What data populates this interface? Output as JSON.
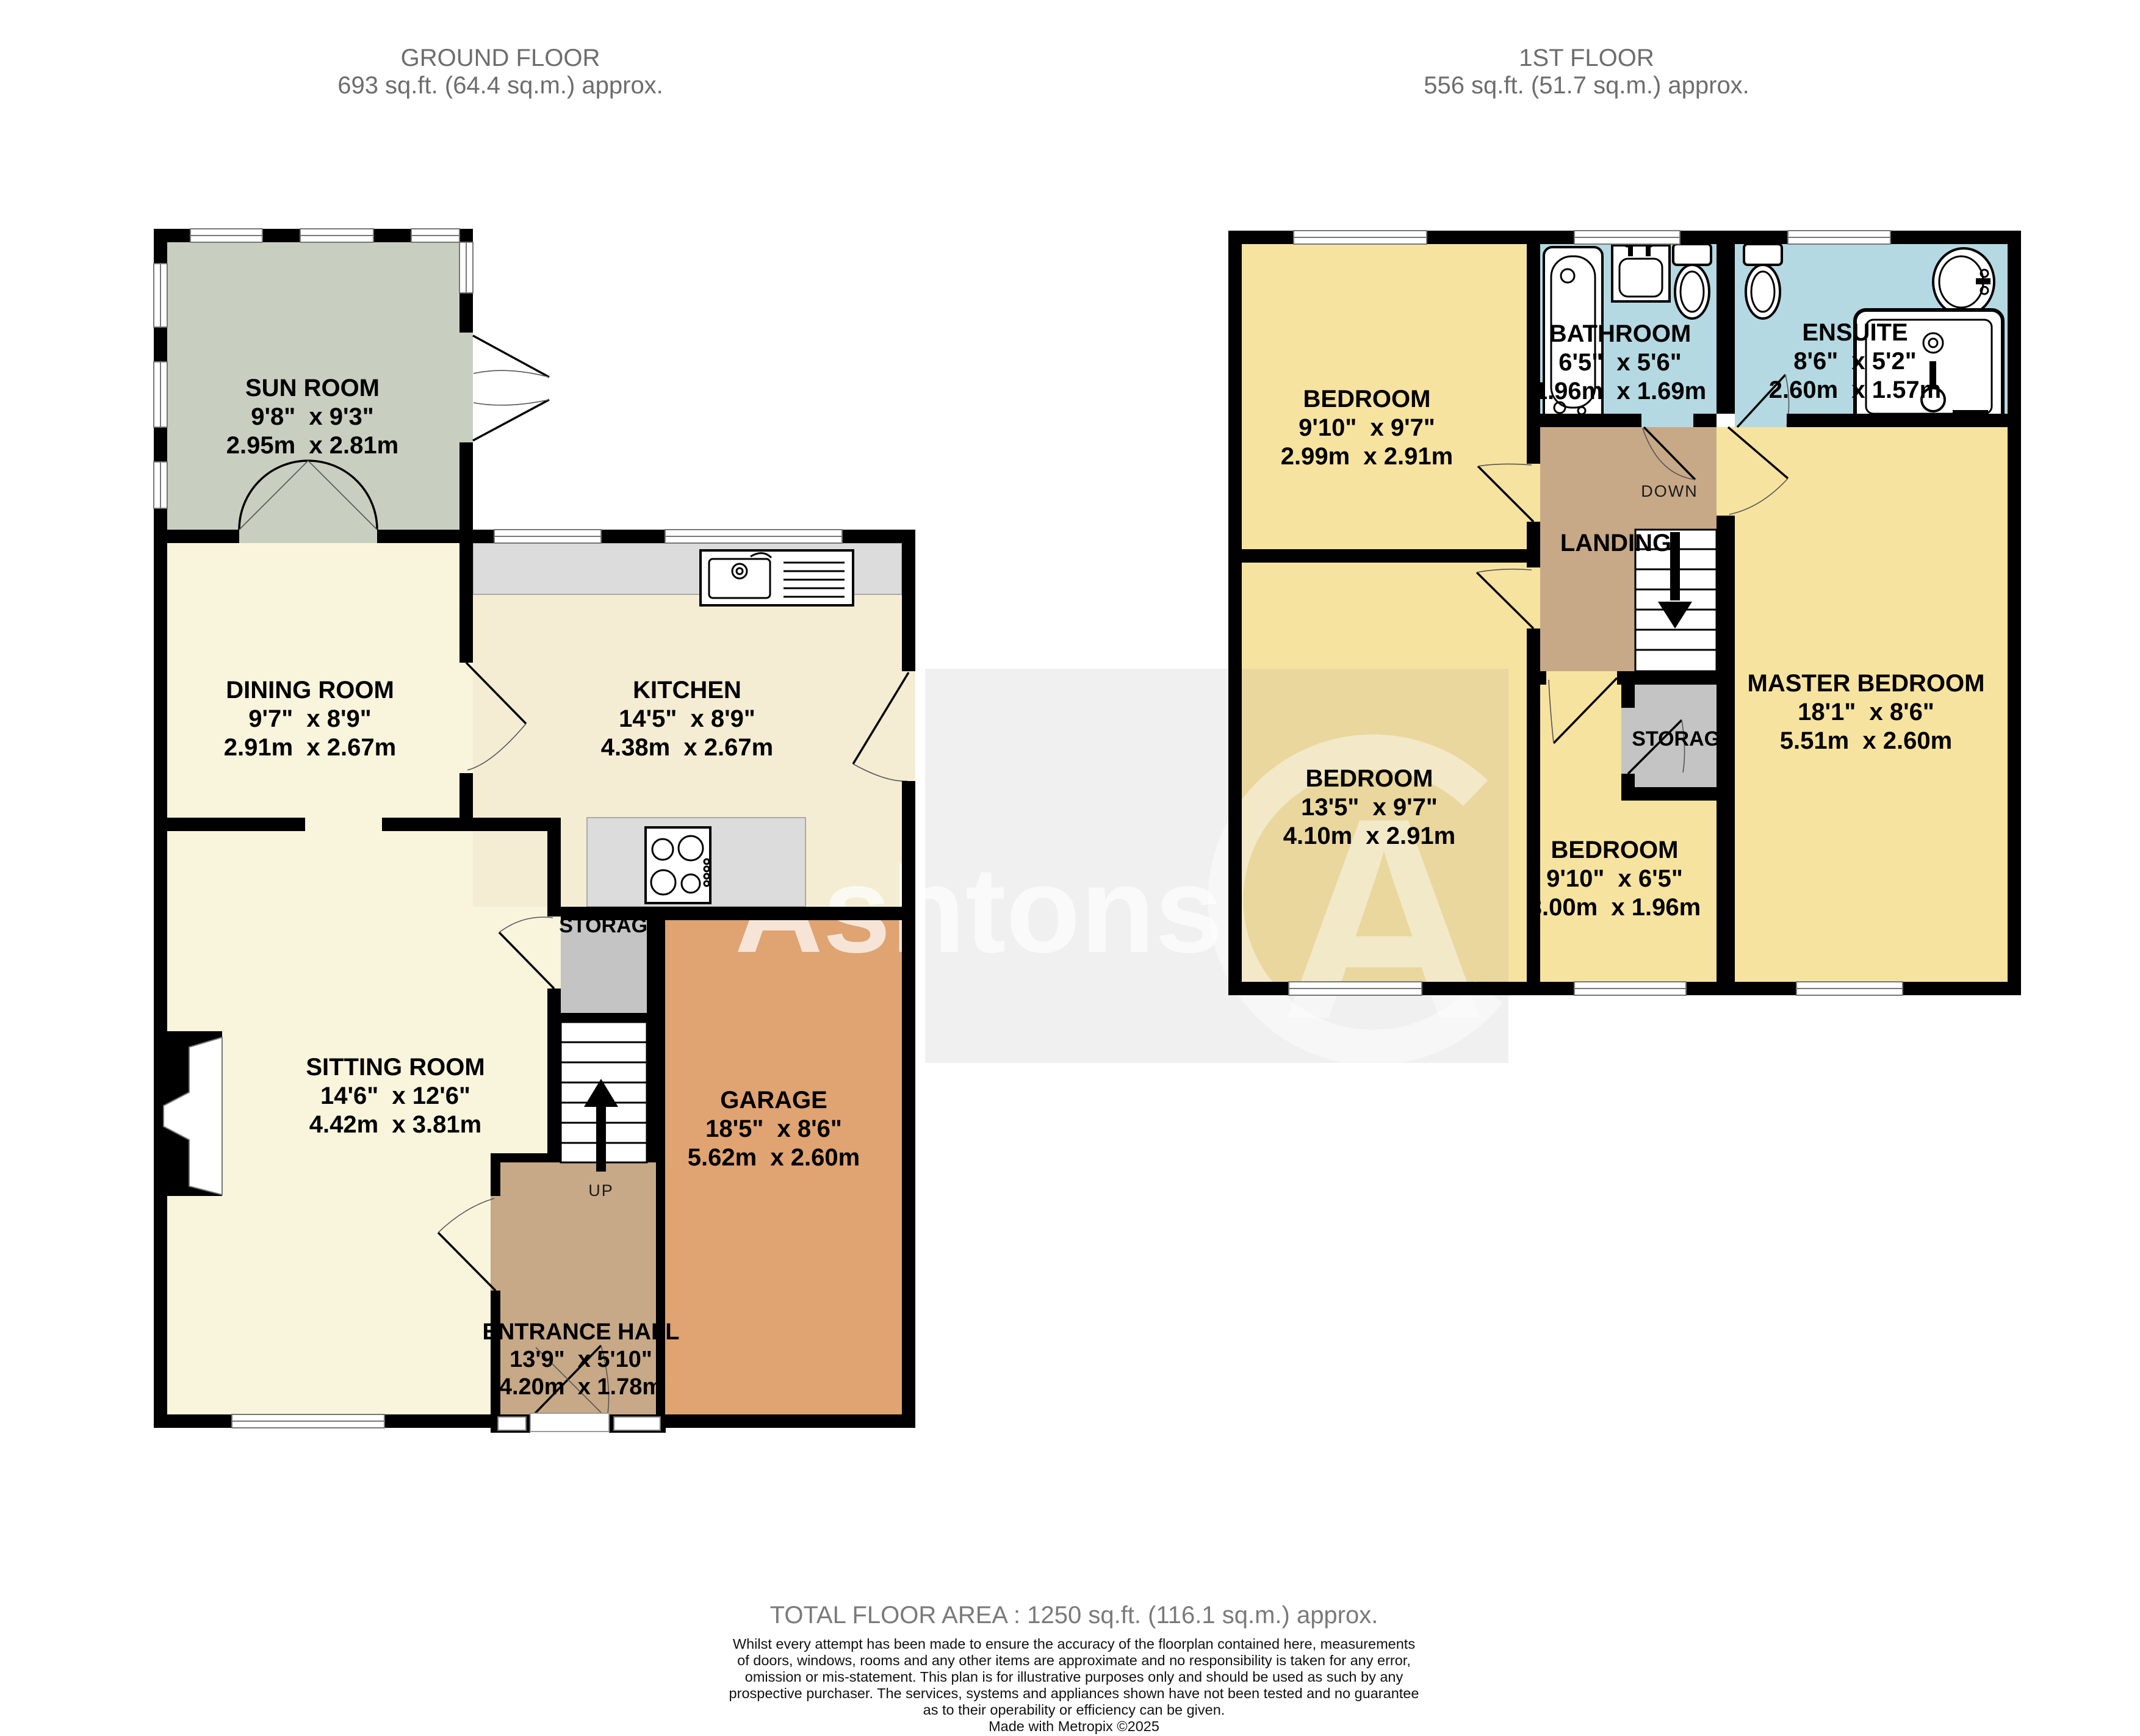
{
  "floors": {
    "ground": {
      "title": "GROUND FLOOR",
      "area": "693 sq.ft. (64.4 sq.m.) approx."
    },
    "first": {
      "title": "1ST FLOOR",
      "area": "556 sq.ft. (51.7 sq.m.) approx."
    }
  },
  "rooms": {
    "sun_room": {
      "name": "SUN ROOM",
      "imperial": "9'8\"  x 9'3\"",
      "metric": "2.95m  x 2.81m"
    },
    "dining_room": {
      "name": "DINING ROOM",
      "imperial": "9'7\"  x 8'9\"",
      "metric": "2.91m  x 2.67m"
    },
    "kitchen": {
      "name": "KITCHEN",
      "imperial": "14'5\"  x 8'9\"",
      "metric": "4.38m  x 2.67m"
    },
    "sitting_room": {
      "name": "SITTING ROOM",
      "imperial": "14'6\"  x 12'6\"",
      "metric": "4.42m  x 3.81m"
    },
    "garage": {
      "name": "GARAGE",
      "imperial": "18'5\"  x 8'6\"",
      "metric": "5.62m  x 2.60m"
    },
    "entrance_hall": {
      "name": "ENTRANCE HALL",
      "imperial": "13'9\"  x 5'10\"",
      "metric": "4.20m  x 1.78m"
    },
    "bedroom_front": {
      "name": "BEDROOM",
      "imperial": "9'10\"  x 9'7\"",
      "metric": "2.99m  x 2.91m"
    },
    "bathroom": {
      "name": "BATHROOM",
      "imperial": "6'5\"  x 5'6\"",
      "metric": "1.96m  x 1.69m"
    },
    "ensuite": {
      "name": "ENSUITE",
      "imperial": "8'6\"  x 5'2\"",
      "metric": "2.60m  x 1.57m"
    },
    "bedroom_middle": {
      "name": "BEDROOM",
      "imperial": "13'5\"  x 9'7\"",
      "metric": "4.10m  x 2.91m"
    },
    "bedroom_small": {
      "name": "BEDROOM",
      "imperial": "9'10\"  x 6'5\"",
      "metric": "3.00m  x 1.96m"
    },
    "master_bedroom": {
      "name": "MASTER BEDROOM",
      "imperial": "18'1\"  x 8'6\"",
      "metric": "5.51m  x 2.60m"
    }
  },
  "labels": {
    "storage_ground": "STORAGE",
    "storage_first": "STORAGE",
    "landing": "LANDING",
    "up": "UP",
    "down": "DOWN"
  },
  "watermark": {
    "text": "Ashtons",
    "logo_letter": "A"
  },
  "footer": {
    "total": "TOTAL FLOOR AREA : 1250 sq.ft. (116.1 sq.m.) approx.",
    "disclaimer_lines": [
      "Whilst every attempt has been made to ensure the accuracy of the floorplan contained here, measurements",
      "of doors, windows, rooms and any other items are approximate and no responsibility is taken for any error,",
      "omission or mis-statement. This plan is for illustrative purposes only and should be used as such by any",
      "prospective purchaser. The services, systems and appliances shown have not been tested and no guarantee",
      "as to their operability or efficiency can be given."
    ],
    "credit": "Made with Metropix ©2025"
  },
  "colors": {
    "wall": "#000000",
    "cream": "#f9f4dc",
    "kitchen_floor": "#f4edd3",
    "sun": "#c8cfc0",
    "bedroom": "#f7e3a0",
    "bathroom": "#b5d9e2",
    "hall_tan": "#c7a987",
    "garage": "#e0a372",
    "storage": "#c4c4c4",
    "counter": "#dcdcdc",
    "header_text": "#6d6d6d"
  }
}
